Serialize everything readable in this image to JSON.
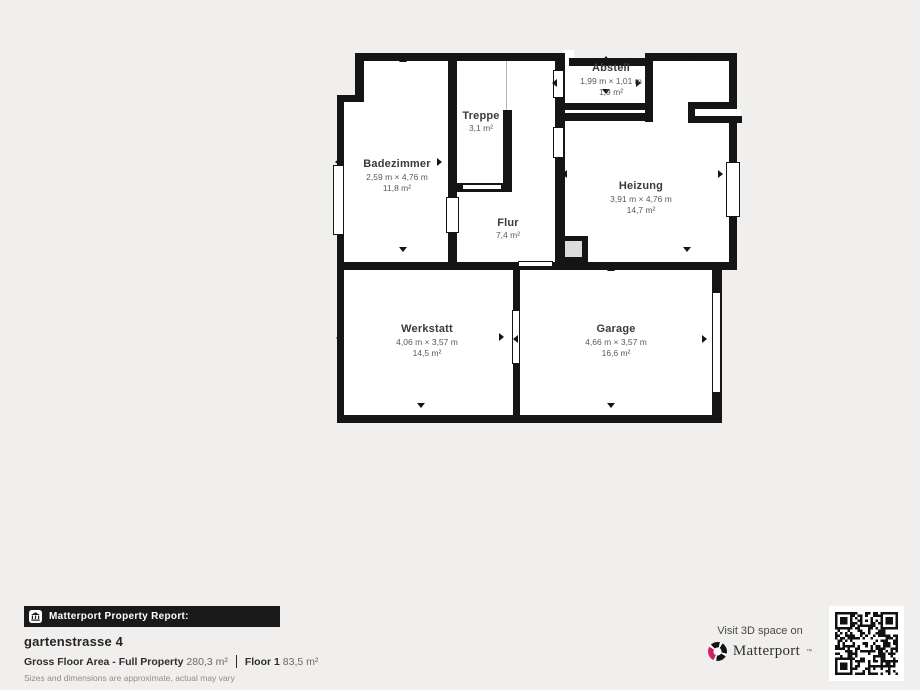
{
  "page": {
    "background": "#f1efed",
    "wall_color": "#151515"
  },
  "plan": {
    "rooms": [
      {
        "name": "Badezimmer",
        "dims": "2,59 m × 4,76 m",
        "area": "11,8 m²",
        "cx": 397,
        "cy": 176
      },
      {
        "name": "Treppe",
        "dims": null,
        "area": "3,1 m²",
        "cx": 481,
        "cy": 122
      },
      {
        "name": "Abstell",
        "dims": "1,99 m × 1,01 m",
        "area": "1,9 m²",
        "cx": 611,
        "cy": 80
      },
      {
        "name": "Flur",
        "dims": null,
        "area": "7,4 m²",
        "cx": 508,
        "cy": 229
      },
      {
        "name": "Heizung",
        "dims": "3,91 m × 4,76 m",
        "area": "14,7 m²",
        "cx": 641,
        "cy": 198
      },
      {
        "name": "Werkstatt",
        "dims": "4,06 m × 3,57 m",
        "area": "14,5 m²",
        "cx": 427,
        "cy": 341
      },
      {
        "name": "Garage",
        "dims": "4,66 m × 3,57 m",
        "area": "16,6 m²",
        "cx": 616,
        "cy": 341
      }
    ],
    "floors": [
      [
        357,
        56,
        98,
        48
      ],
      [
        340,
        97,
        115,
        170
      ],
      [
        450,
        56,
        112,
        211
      ],
      [
        558,
        60,
        92,
        50
      ],
      [
        648,
        56,
        85,
        210
      ],
      [
        560,
        108,
        173,
        158
      ],
      [
        340,
        266,
        378,
        151
      ],
      [
        564,
        50,
        10,
        13
      ]
    ],
    "walls": [
      [
        355,
        53,
        210,
        8
      ],
      [
        355,
        53,
        9,
        49
      ],
      [
        337,
        95,
        26,
        7
      ],
      [
        337,
        95,
        7,
        328
      ],
      [
        337,
        415,
        385,
        8
      ],
      [
        712,
        262,
        10,
        161
      ],
      [
        337,
        262,
        400,
        8
      ],
      [
        729,
        53,
        8,
        217
      ],
      [
        569,
        58,
        83,
        8
      ],
      [
        645,
        53,
        92,
        8
      ],
      [
        555,
        53,
        10,
        217
      ],
      [
        645,
        53,
        8,
        69
      ],
      [
        557,
        103,
        95,
        7
      ],
      [
        557,
        113,
        95,
        8
      ],
      [
        688,
        102,
        49,
        7
      ],
      [
        688,
        116,
        54,
        7
      ],
      [
        688,
        102,
        7,
        21
      ],
      [
        448,
        53,
        9,
        217
      ],
      [
        503,
        110,
        9,
        82
      ],
      [
        457,
        183,
        55,
        9
      ],
      [
        513,
        270,
        7,
        153
      ]
    ],
    "openings": [
      {
        "r": [
          333,
          165,
          11,
          70
        ],
        "b": 1,
        "t": "window"
      },
      {
        "r": [
          446,
          197,
          13,
          36
        ],
        "b": 1,
        "t": "door"
      },
      {
        "r": [
          462,
          184,
          40,
          6
        ],
        "b": 1,
        "t": "door"
      },
      {
        "r": [
          553,
          70,
          11,
          28
        ],
        "b": 1,
        "t": "door"
      },
      {
        "r": [
          553,
          127,
          11,
          31
        ],
        "b": 1,
        "t": "door"
      },
      {
        "r": [
          726,
          162,
          14,
          55
        ],
        "b": 1,
        "t": "window"
      },
      {
        "r": [
          727,
          109,
          14,
          7
        ],
        "b": 0,
        "t": "gap"
      },
      {
        "r": [
          518,
          261,
          35,
          6
        ],
        "b": 1,
        "t": "door"
      },
      {
        "r": [
          512,
          310,
          8,
          54
        ],
        "b": 1,
        "t": "door"
      },
      {
        "r": [
          712,
          292,
          9,
          101
        ],
        "b": 1,
        "t": "door"
      }
    ],
    "chimney": {
      "outer": [
        560,
        236,
        28,
        26
      ],
      "inner": [
        565,
        241,
        17,
        16
      ]
    },
    "stair_line": [
      506,
      61,
      1,
      49
    ],
    "arrows": [
      {
        "x": 403,
        "y": 61,
        "d": "up"
      },
      {
        "x": 403,
        "y": 251,
        "d": "down"
      },
      {
        "x": 339,
        "y": 162,
        "d": "left"
      },
      {
        "x": 441,
        "y": 162,
        "d": "right"
      },
      {
        "x": 606,
        "y": 60,
        "d": "up"
      },
      {
        "x": 606,
        "y": 93,
        "d": "down"
      },
      {
        "x": 556,
        "y": 83,
        "d": "left"
      },
      {
        "x": 640,
        "y": 83,
        "d": "right"
      },
      {
        "x": 690,
        "y": 60,
        "d": "up"
      },
      {
        "x": 687,
        "y": 251,
        "d": "down"
      },
      {
        "x": 566,
        "y": 174,
        "d": "left"
      },
      {
        "x": 722,
        "y": 174,
        "d": "right"
      },
      {
        "x": 421,
        "y": 269,
        "d": "up"
      },
      {
        "x": 421,
        "y": 407,
        "d": "down"
      },
      {
        "x": 340,
        "y": 338,
        "d": "left"
      },
      {
        "x": 503,
        "y": 337,
        "d": "right"
      },
      {
        "x": 611,
        "y": 270,
        "d": "up"
      },
      {
        "x": 611,
        "y": 407,
        "d": "down"
      },
      {
        "x": 517,
        "y": 339,
        "d": "left"
      },
      {
        "x": 706,
        "y": 339,
        "d": "right"
      }
    ]
  },
  "footer": {
    "report_label": "Matterport Property Report:",
    "property_name": "gartenstrasse 4",
    "gross_label": "Gross Floor Area - Full Property",
    "gross_value": "280,3 m²",
    "floor_label": "Floor 1",
    "floor_value": "83,5 m²",
    "disclaimer": "Sizes and dimensions are approximate, actual may vary"
  },
  "cta": {
    "visit_text": "Visit 3D space on",
    "brand": "Matterport",
    "tm": "™"
  },
  "icons": {
    "report_icon": "building-columns-icon",
    "brand_icon": "matterport-aperture-icon",
    "qr": "qr-code"
  }
}
